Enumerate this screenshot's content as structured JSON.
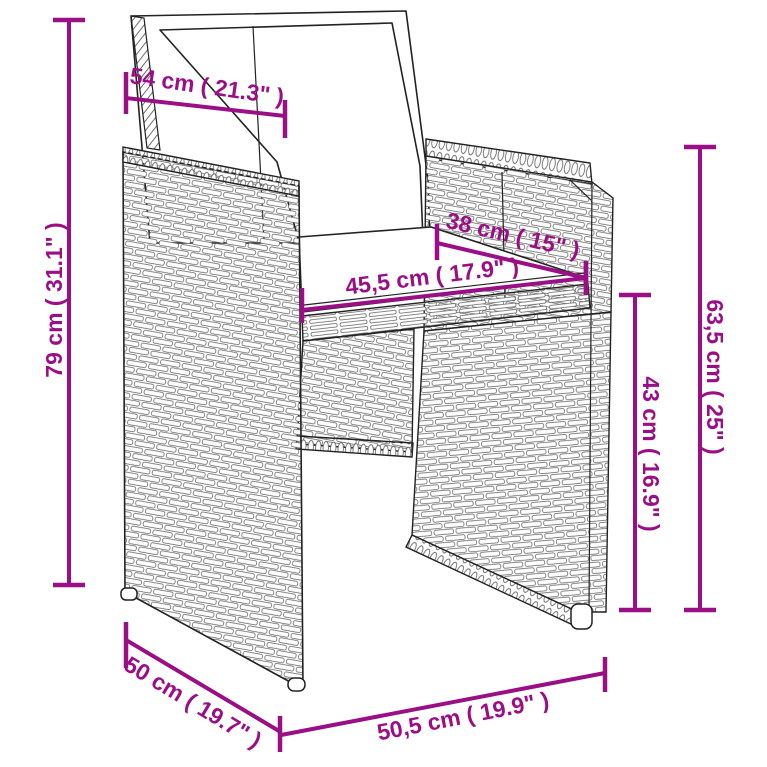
{
  "diagram": {
    "type": "product-dimension-diagram",
    "subject": "poly rattan garden chair with cushions",
    "accent_color": "#9a0f85",
    "line_color": "#222222",
    "dimensions": {
      "back_width": "54 cm ( 21.3\" )",
      "total_height": "79 cm ( 31.1\" )",
      "seat_depth": "38 cm ( 15\" )",
      "seat_width": "45,5 cm ( 17.9\" )",
      "armrest_height": "63,5 cm ( 25\" )",
      "seat_height": "43 cm ( 16.9\" )",
      "base_depth": "50 cm ( 19.7\" )",
      "base_width": "50,5 cm ( 19.9\" )"
    }
  }
}
